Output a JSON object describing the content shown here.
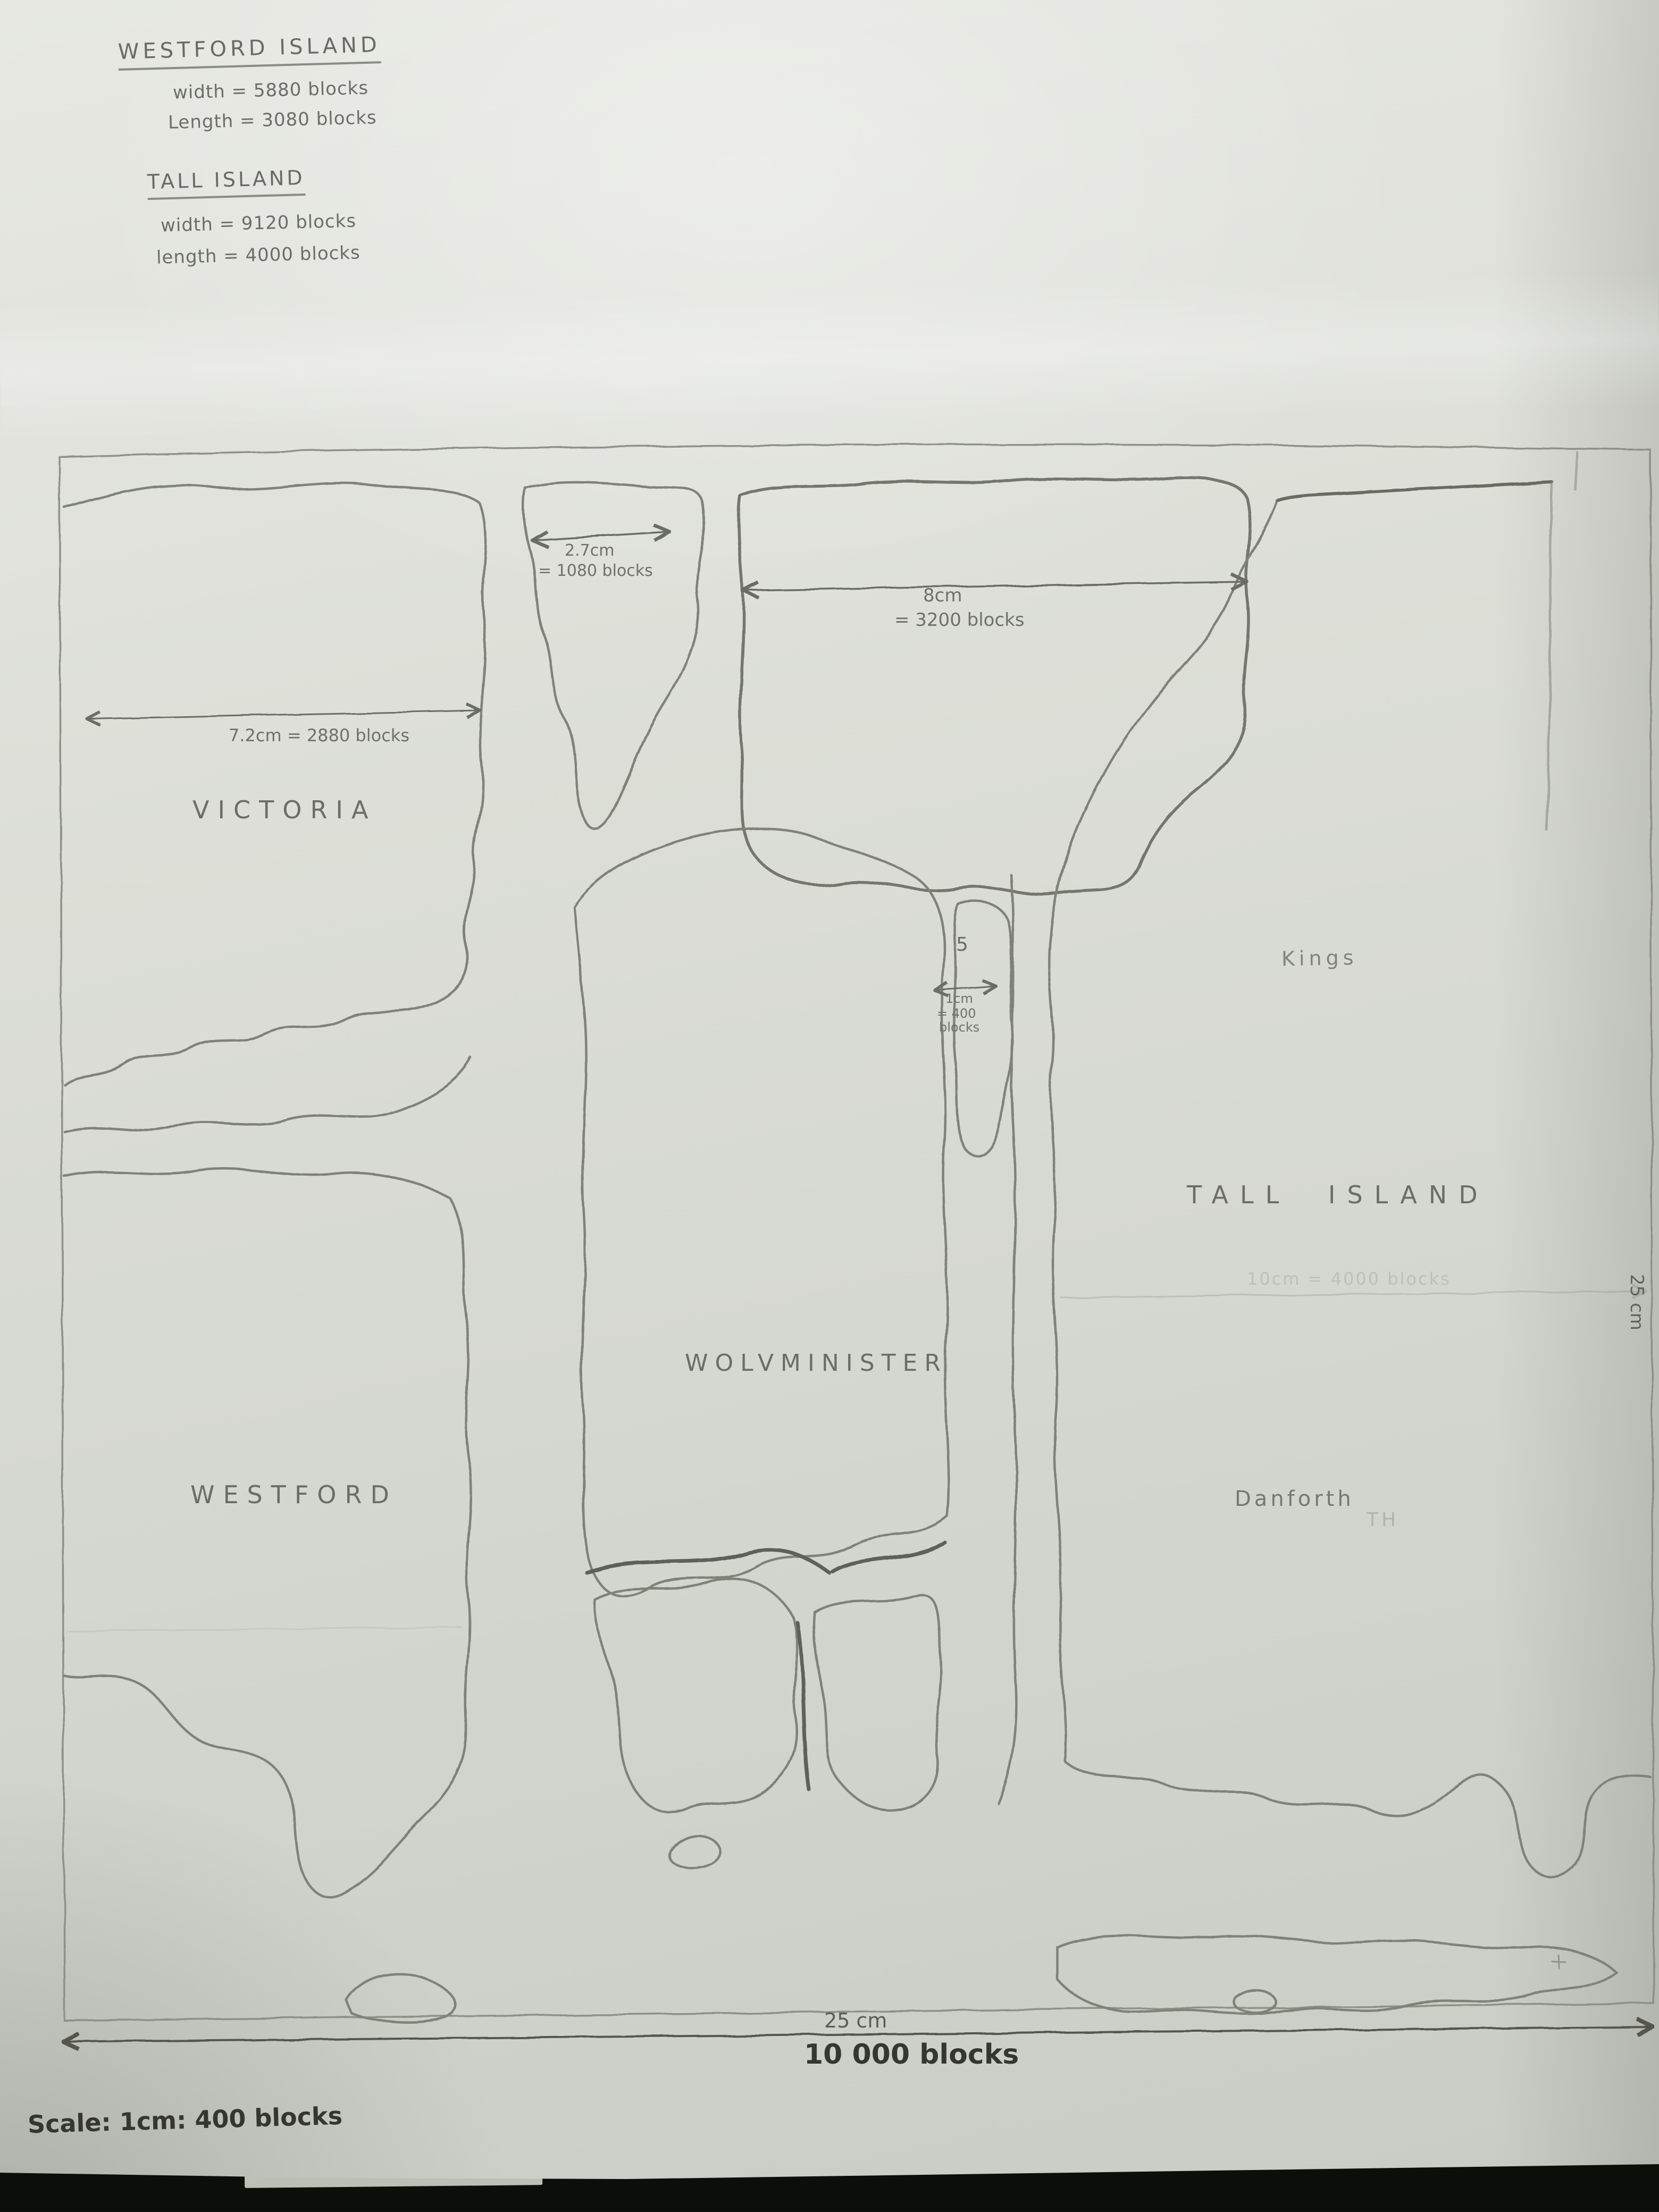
{
  "page": {
    "description": "Photographed pencil-drawn fantasy map of islands on white paper"
  },
  "notes": {
    "westford": {
      "title": "WESTFORD ISLAND",
      "width": "width = 5880 blocks",
      "length": "Length = 3080 blocks"
    },
    "tall": {
      "title": "TALL ISLAND",
      "width": "width = 9120 blocks",
      "length": "length = 4000 blocks"
    }
  },
  "labels": {
    "victoria": "VICTORIA",
    "westford": "WESTFORD",
    "wolvminister": "WOLVMINISTER",
    "tall_island": "TALL ISLAND",
    "kings": "Kings",
    "danforth": "Danforth",
    "danforth_faint": "TH",
    "islet_number": "5"
  },
  "annotations": {
    "victoria_width": "7.2cm = 2880 blocks",
    "north_islet_cm": "2.7cm",
    "north_islet_blocks": "= 1080 blocks",
    "north_island_cm": "8cm",
    "north_island_blocks": "= 3200 blocks",
    "small_island_cm": "1cm",
    "small_island_eq": "= 400",
    "small_island_unit": "blocks",
    "tall_length_faint": "10cm = 4000 blocks"
  },
  "scale_bar": {
    "cm": "25 cm",
    "blocks": "10 000 blocks",
    "right_cm": "25 cm"
  },
  "footer": {
    "scale_note": "Scale: 1cm: 400 blocks"
  },
  "colors": {
    "paper": "#dcded7",
    "pencil": "#80827a",
    "pencil_dark": "#5e605a",
    "ink_dark": "#35362f",
    "background": "#10140d"
  }
}
